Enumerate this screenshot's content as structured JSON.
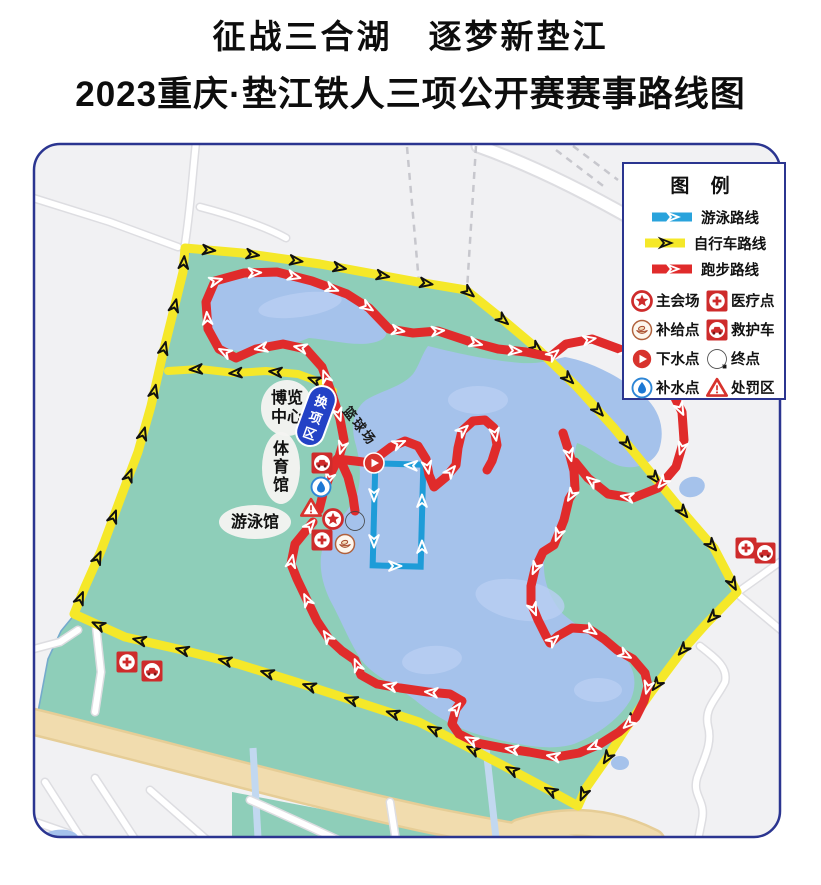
{
  "title": {
    "line1": "征战三合湖　逐梦新垫江",
    "line2": "2023重庆·垫江铁人三项公开赛赛事路线图"
  },
  "legend": {
    "title": "图  例",
    "routes": [
      {
        "name": "swim",
        "label": "游泳路线",
        "color": "#29A3DC",
        "arrow": "#ffffff"
      },
      {
        "name": "bike",
        "label": "自行车路线",
        "color": "#F5E829",
        "arrow": "#111111"
      },
      {
        "name": "run",
        "label": "跑步路线",
        "color": "#E02B2B",
        "arrow": "#ffffff"
      }
    ],
    "points": [
      {
        "icon": "main-venue",
        "label": "主会场"
      },
      {
        "icon": "medical",
        "label": "医疗点"
      },
      {
        "icon": "supply",
        "label": "补给点"
      },
      {
        "icon": "ambulance",
        "label": "救护车"
      },
      {
        "icon": "water-entry",
        "label": "下水点"
      },
      {
        "icon": "finish",
        "label": "终点"
      },
      {
        "icon": "water-supply",
        "label": "补水点"
      },
      {
        "icon": "penalty",
        "label": "处罚区"
      }
    ]
  },
  "map": {
    "colors": {
      "city": "#F1F1F3",
      "park": "#8ECEB9",
      "parkEdge": "#74AACC",
      "lake": "#A5C2EB",
      "lakeLight": "#B9CEF2",
      "roadEdge": "#DDDDE1",
      "dash": "#C7C7CD",
      "beige": "#F1DCAE",
      "beigeEdge": "#E6CD96",
      "stream": "#C2D8F0",
      "bike": "#F5E829",
      "run": "#E02B2B",
      "swim": "#1E9CD8",
      "frame": "#2B3590",
      "pill": "#2342C6"
    },
    "labels": [
      {
        "id": "expo-center",
        "text": "博览中心",
        "lines": [
          "博览",
          "中心"
        ],
        "x": 287,
        "y": 408,
        "rx": 26,
        "ry": 28,
        "mode": "h2"
      },
      {
        "id": "gymnasium",
        "text": "体育馆",
        "x": 281,
        "y": 468,
        "rx": 19,
        "ry": 36,
        "mode": "v"
      },
      {
        "id": "swimming-hall",
        "text": "游泳馆",
        "x": 255,
        "y": 522,
        "rx": 36,
        "ry": 17,
        "mode": "h"
      },
      {
        "id": "basketball-court",
        "text": "篮球场",
        "x": 349,
        "y": 414,
        "rotate": 52,
        "mode": "plain"
      },
      {
        "id": "transition-zone",
        "text": "换项区",
        "x": 316,
        "y": 416,
        "rotate": 20,
        "mode": "pill"
      }
    ],
    "markers": [
      {
        "type": "ambulance",
        "x": 322,
        "y": 463
      },
      {
        "type": "water-supply",
        "x": 321,
        "y": 487
      },
      {
        "type": "penalty",
        "x": 311,
        "y": 508
      },
      {
        "type": "main-venue",
        "x": 333,
        "y": 519
      },
      {
        "type": "finish",
        "x": 355,
        "y": 521
      },
      {
        "type": "medical",
        "x": 322,
        "y": 540
      },
      {
        "type": "supply",
        "x": 345,
        "y": 544
      },
      {
        "type": "water-entry",
        "x": 374,
        "y": 463
      },
      {
        "type": "medical",
        "x": 746,
        "y": 548
      },
      {
        "type": "ambulance",
        "x": 765,
        "y": 553
      },
      {
        "type": "medical",
        "x": 127,
        "y": 662
      },
      {
        "type": "ambulance",
        "x": 152,
        "y": 671
      }
    ],
    "routes": {
      "bike_main": [
        [
          185,
          248
        ],
        [
          242,
          253
        ],
        [
          320,
          264
        ],
        [
          412,
          281
        ],
        [
          466,
          290
        ],
        [
          502,
          319
        ],
        [
          540,
          351
        ],
        [
          577,
          387
        ],
        [
          614,
          428
        ],
        [
          651,
          473
        ],
        [
          688,
          518
        ],
        [
          714,
          548
        ],
        [
          737,
          592
        ],
        [
          706,
          624
        ],
        [
          682,
          651
        ],
        [
          652,
          691
        ],
        [
          626,
          728
        ],
        [
          607,
          758
        ],
        [
          586,
          788
        ],
        [
          578,
          806
        ],
        [
          549,
          790
        ],
        [
          506,
          767
        ],
        [
          462,
          744
        ],
        [
          419,
          722
        ],
        [
          296,
          682
        ],
        [
          238,
          664
        ],
        [
          178,
          649
        ],
        [
          125,
          637
        ],
        [
          74,
          614
        ],
        [
          85,
          587
        ],
        [
          101,
          551
        ],
        [
          121,
          497
        ],
        [
          138,
          452
        ],
        [
          151,
          406
        ],
        [
          164,
          349
        ],
        [
          171,
          321
        ],
        [
          183,
          272
        ],
        [
          185,
          248
        ]
      ],
      "bike_spur": [
        [
          168,
          371
        ],
        [
          200,
          369
        ],
        [
          235,
          373
        ],
        [
          266,
          371
        ],
        [
          298,
          374
        ],
        [
          320,
          382
        ],
        [
          333,
          391
        ]
      ],
      "run_main": [
        [
          333,
          397
        ],
        [
          322,
          367
        ],
        [
          306,
          349
        ],
        [
          283,
          344
        ],
        [
          256,
          349
        ],
        [
          236,
          358
        ],
        [
          219,
          349
        ],
        [
          208,
          329
        ],
        [
          206,
          302
        ],
        [
          215,
          281
        ],
        [
          244,
          273
        ],
        [
          277,
          272
        ],
        [
          312,
          281
        ],
        [
          347,
          294
        ],
        [
          369,
          308
        ],
        [
          389,
          329
        ],
        [
          413,
          333
        ],
        [
          438,
          331
        ],
        [
          468,
          341
        ],
        [
          498,
          349
        ],
        [
          526,
          352
        ],
        [
          550,
          357
        ],
        [
          566,
          344
        ],
        [
          592,
          339
        ],
        [
          622,
          350
        ],
        [
          649,
          366
        ],
        [
          670,
          388
        ],
        [
          682,
          412
        ],
        [
          684,
          440
        ],
        [
          676,
          467
        ],
        [
          658,
          488
        ],
        [
          633,
          498
        ],
        [
          608,
          494
        ],
        [
          588,
          478
        ],
        [
          575,
          462
        ]
      ],
      "run_descent": [
        [
          563,
          433
        ],
        [
          569,
          452
        ],
        [
          574,
          471
        ],
        [
          575,
          489
        ],
        [
          569,
          499
        ],
        [
          564,
          520
        ],
        [
          554,
          545
        ],
        [
          543,
          552
        ],
        [
          535,
          569
        ],
        [
          531,
          586
        ],
        [
          531,
          603
        ],
        [
          538,
          620
        ],
        [
          546,
          636
        ],
        [
          550,
          643
        ],
        [
          558,
          636
        ],
        [
          572,
          628
        ],
        [
          589,
          629
        ],
        [
          604,
          639
        ],
        [
          617,
          650
        ],
        [
          633,
          659
        ],
        [
          645,
          673
        ],
        [
          648,
          686
        ],
        [
          644,
          701
        ],
        [
          636,
          717
        ],
        [
          619,
          732
        ],
        [
          600,
          744
        ],
        [
          579,
          753
        ],
        [
          556,
          757
        ],
        [
          529,
          752
        ],
        [
          503,
          748
        ],
        [
          477,
          743
        ],
        [
          459,
          734
        ],
        [
          452,
          724
        ],
        [
          456,
          709
        ],
        [
          462,
          701
        ],
        [
          450,
          694
        ],
        [
          428,
          692
        ],
        [
          400,
          688
        ],
        [
          377,
          684
        ],
        [
          361,
          675
        ],
        [
          355,
          660
        ],
        [
          342,
          651
        ],
        [
          329,
          639
        ],
        [
          317,
          621
        ],
        [
          307,
          600
        ],
        [
          297,
          579
        ],
        [
          291,
          564
        ],
        [
          295,
          544
        ],
        [
          313,
          522
        ]
      ],
      "run_conn1": [
        [
          333,
          397
        ],
        [
          340,
          419
        ],
        [
          344,
          440
        ],
        [
          339,
          457
        ],
        [
          330,
          475
        ],
        [
          323,
          494
        ],
        [
          319,
          510
        ]
      ],
      "run_conn2": [
        [
          339,
          457
        ],
        [
          348,
          477
        ],
        [
          353,
          497
        ],
        [
          355,
          511
        ]
      ],
      "run_conn3": [
        [
          337,
          459
        ],
        [
          355,
          461
        ],
        [
          371,
          463
        ]
      ],
      "run_wiggle": [
        [
          379,
          456
        ],
        [
          391,
          447
        ],
        [
          405,
          441
        ],
        [
          418,
          446
        ],
        [
          426,
          459
        ],
        [
          429,
          475
        ],
        [
          434,
          487
        ],
        [
          446,
          477
        ],
        [
          456,
          465
        ],
        [
          458,
          448
        ],
        [
          462,
          431
        ],
        [
          473,
          421
        ],
        [
          485,
          420
        ],
        [
          494,
          428
        ],
        [
          497,
          445
        ],
        [
          492,
          461
        ],
        [
          487,
          470
        ]
      ],
      "swim_rect": {
        "x": 374,
        "y": 464,
        "w": 48,
        "h": 102,
        "rotate": 1.5
      },
      "swim_arrows": [
        [
          374,
          470
        ],
        [
          374,
          566
        ],
        [
          422,
          566
        ],
        [
          422,
          466
        ],
        [
          380,
          464
        ]
      ]
    },
    "geometry": {
      "park": "M190,250 L300,262 L412,281 L466,290 L520,333 L577,387 L650,473 L713,548 L737,592 L683,650 L627,727 L597,775 L578,806 L540,836 L417,820 L297,789 L163,752 L38,712 L48,659 L61,631 L75,614 L85,587 L101,551 L121,497 L138,452 L151,406 L164,349 L171,321 L183,272 Z",
      "park2": "M232,792 L420,828 L500,838 L232,838 Z",
      "lakes": [
        "M205,299 C209,284 236,277 266,276 C300,276 341,291 371,312 C385,322 392,334 381,340 C362,349 334,340 309,338 C281,349 247,356 227,348 C210,341 201,314 205,299 Z",
        "M428,346 C452,352 486,360 521,363 C541,364 552,360 565,357 C593,362 625,379 648,400 C661,414 665,432 659,450 C653,464 636,470 620,466 C604,461 592,448 577,443 C572,459 574,478 571,497 C567,516 554,534 545,556 C541,576 549,598 563,614 C580,629 604,641 622,655 C634,666 638,682 631,699 C621,717 600,734 574,744 C548,752 516,744 487,737 C459,730 434,716 415,700 C396,685 372,676 360,658 C349,641 341,620 330,600 C321,581 317,560 325,541 C334,523 350,511 357,494 C362,478 360,459 355,442 C351,427 353,410 366,400 C380,391 402,387 413,374 C419,366 422,354 428,346 Z"
      ],
      "lakePatches": [
        [
          300,
          305,
          42,
          12,
          -8
        ],
        [
          478,
          400,
          30,
          14,
          0
        ],
        [
          520,
          600,
          45,
          20,
          10
        ],
        [
          432,
          660,
          30,
          14,
          -5
        ],
        [
          598,
          690,
          24,
          12,
          0
        ]
      ],
      "beige": [
        "M26,720 C150,750 300,792 430,820 C500,834 550,842 598,852",
        "M520,832 C570,816 612,822 652,842",
        "M470,834 C500,852 520,866 540,882"
      ],
      "streams": [
        "M253,748 L258,838",
        "M486,748 L496,838"
      ],
      "roads": [
        "M30,197 L110,222 L178,247",
        "M196,142 C192,180 190,215 184,250",
        "M200,207 C235,216 268,228 286,238",
        "M738,592 L780,562 L821,548",
        "M740,596 L788,636 L821,662",
        "M700,646 C718,660 728,668 725,682 C716,700 704,708 708,726 C713,744 703,760 697,778 C692,796 706,800 702,820 L698,840",
        "M96,626 L101,672 L95,712",
        "M30,650 L60,642 L78,630",
        "M45,782 L95,860",
        "M95,778 L150,862",
        "M30,820 L180,872",
        "M150,790 L230,860",
        "M250,800 C300,822 360,850 415,876",
        "M390,802 L402,880",
        "M480,840 L520,884"
      ],
      "bigroads": [
        "M478,146 C540,168 600,200 648,228 C668,240 690,252 708,263"
      ],
      "dashed": [
        "M407,147 L419,283",
        "M476,146 L467,290",
        "M556,150 L606,188",
        "M573,146 L618,180"
      ],
      "ponds": [
        [
          692,
          487,
          13,
          10,
          -15
        ],
        [
          620,
          763,
          9,
          7,
          0
        ],
        [
          57,
          842,
          22,
          12,
          -10
        ]
      ],
      "frame": {
        "x": 34,
        "y": 144,
        "w": 746,
        "h": 693,
        "r": 26
      }
    }
  }
}
